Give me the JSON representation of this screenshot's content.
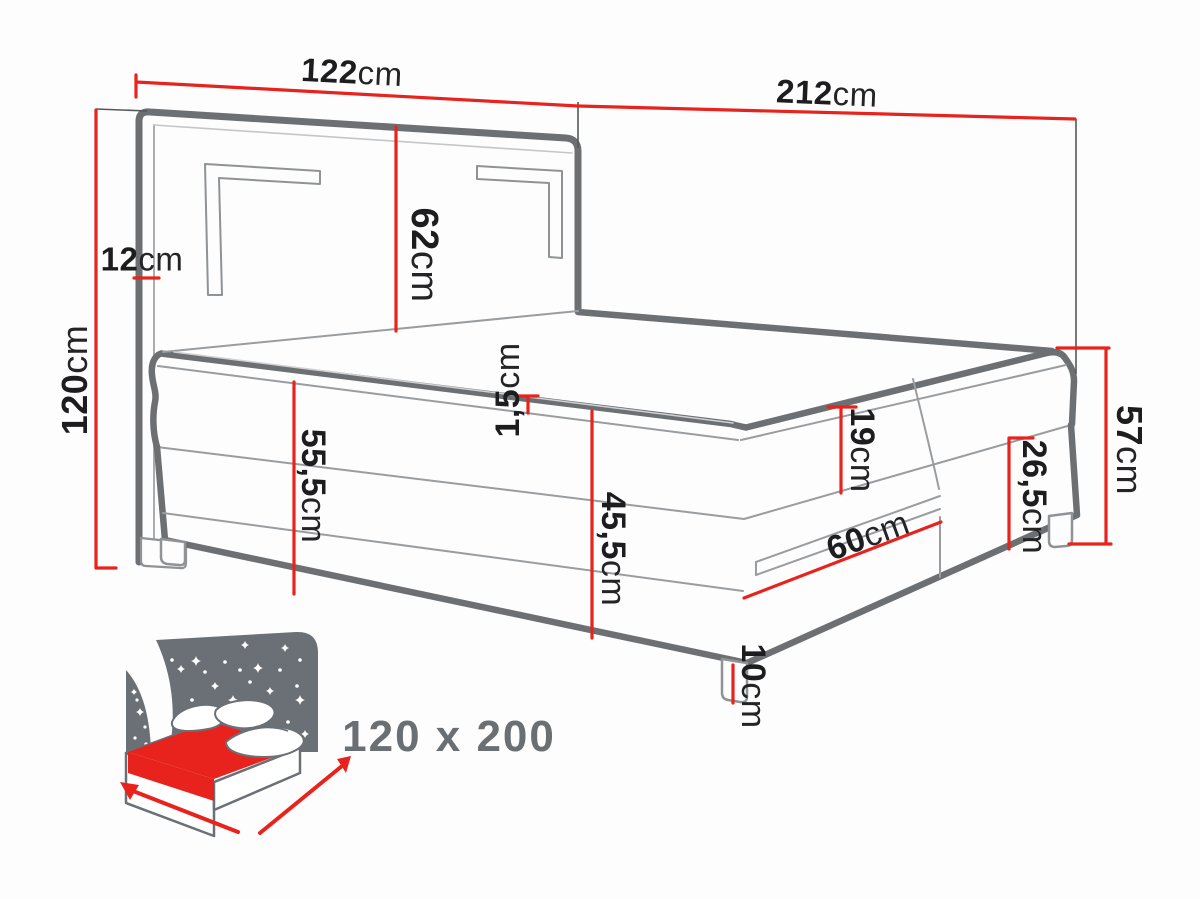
{
  "diagram": {
    "type": "furniture-dimension-diagram",
    "subject": "boxspring bed with LED headboard",
    "colors": {
      "dimension_red": "#e8231d",
      "drawing_gray": "#6c7073",
      "label_black": "#1d1d1f",
      "icon_gray": "#6b7076"
    },
    "dimensions": {
      "d122": {
        "num": "122",
        "unit": "cm"
      },
      "d212": {
        "num": "212",
        "unit": "cm"
      },
      "d120": {
        "num": "120",
        "unit": "cm"
      },
      "d12": {
        "num": "12",
        "unit": "cm"
      },
      "d62": {
        "num": "62",
        "unit": "cm"
      },
      "d1_5": {
        "num": "1,5",
        "unit": "cm"
      },
      "d55_5": {
        "num": "55,5",
        "unit": "cm"
      },
      "d45_5": {
        "num": "45,5",
        "unit": "cm"
      },
      "d19": {
        "num": "19",
        "unit": "cm"
      },
      "d60": {
        "num": "60",
        "unit": "cm"
      },
      "d26_5": {
        "num": "26,5",
        "unit": "cm"
      },
      "d57": {
        "num": "57",
        "unit": "cm"
      },
      "d10": {
        "num": "10",
        "unit": "cm"
      }
    },
    "size_badge": {
      "text": "120 x 200"
    }
  }
}
